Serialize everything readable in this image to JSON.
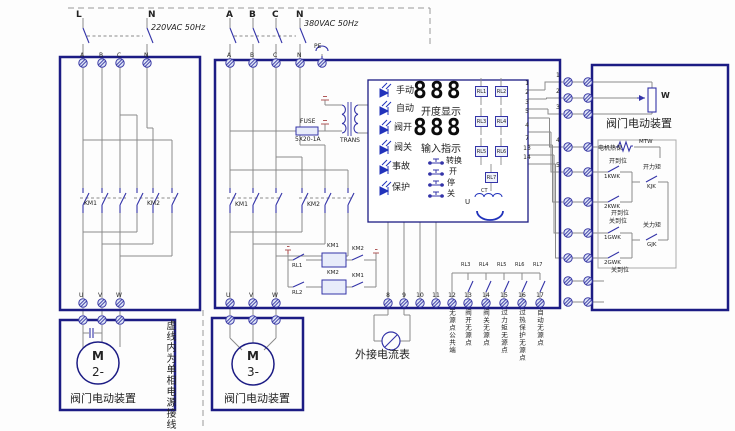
{
  "incoming_left": {
    "l": "L",
    "n": "N",
    "voltage": "220VAC 50Hz"
  },
  "incoming_main": {
    "a": "A",
    "b": "B",
    "c": "C",
    "n": "N",
    "voltage": "380VAC 50Hz"
  },
  "left_cabinet": {
    "top_terminals": [
      "A",
      "B",
      "C",
      "N"
    ],
    "contactor1": "KM1",
    "contactor2": "KM2",
    "bottom_terminals": [
      "U",
      "V",
      "W"
    ]
  },
  "main_cabinet": {
    "top_terminals": [
      "A",
      "B",
      "C",
      "N",
      "PE"
    ],
    "fuse_label": "FUSE",
    "fuse_rating": "5X20-1A",
    "transformer": "TRANS",
    "contactor1": "KM1",
    "contactor2": "KM2",
    "relay1": "RL1",
    "relay2": "RL2",
    "coil1": "KM1",
    "coil2": "KM2",
    "interlock1": "KM2",
    "interlock2": "KM1",
    "bottom_terminals": [
      "U",
      "V",
      "W"
    ]
  },
  "module": {
    "leds": [
      "手动",
      "自动",
      "阀开",
      "阀关",
      "事故",
      "保护"
    ],
    "display_top": {
      "value": "888",
      "caption": "开度显示"
    },
    "display_bottom": {
      "value": "888",
      "caption": "输入指示"
    },
    "buttons": [
      "转换",
      "开",
      "停",
      "关"
    ],
    "relays": [
      "RL1",
      "RL2",
      "RL3",
      "RL4",
      "RL5",
      "RL6",
      "RL7"
    ],
    "ct_label": "CT",
    "u_label": "U",
    "pin_numbers": [
      "1",
      "2",
      "3",
      "5",
      "4",
      "7",
      "13",
      "14"
    ]
  },
  "bottom_strip": {
    "numbers": [
      "8",
      "9",
      "10",
      "11",
      "12",
      "13",
      "14",
      "15",
      "16",
      "17"
    ],
    "contact_relays": [
      "RL3",
      "RL4",
      "RL5",
      "RL6",
      "RL7"
    ],
    "labels": [
      "无源点公共端",
      "阀开无源点",
      "阀关无源点",
      "过力矩无源点",
      "过热保护无源点",
      "自动无源点"
    ]
  },
  "ammeter_label": "外接电流表",
  "dashed_note": "虚线内为单相电源接线",
  "motor2": {
    "m": "M",
    "num": "2-",
    "caption": "阀门电动装置"
  },
  "motor3": {
    "m": "M",
    "num": "3-",
    "caption": "阀门电动装置"
  },
  "right_strip_numbers": [
    "1",
    "2",
    "3",
    "4",
    "5"
  ],
  "right_actuator": {
    "title": "阀门电动装置",
    "pot": "W",
    "thermal_label": "电机热保",
    "thermal_switch": "MTW",
    "open_limit_label": "开到位",
    "open_limit_sw1": "1KWK",
    "open_limit_sw2": "2KWK",
    "open_limit_label2": "开到位",
    "open_torque_label": "开力矩",
    "open_torque_sw": "KJK",
    "close_limit_label": "关到位",
    "close_limit_sw1": "1GWK",
    "close_limit_sw2": "2GWK",
    "close_limit_label2": "关到位",
    "close_torque_label": "关力矩",
    "close_torque_sw": "GJK"
  },
  "colors": {
    "border": "#1c1c84",
    "wire": "#8a8a8a",
    "symbol": "#3434a8",
    "led": "#2233bb",
    "mark": "#b05858"
  }
}
